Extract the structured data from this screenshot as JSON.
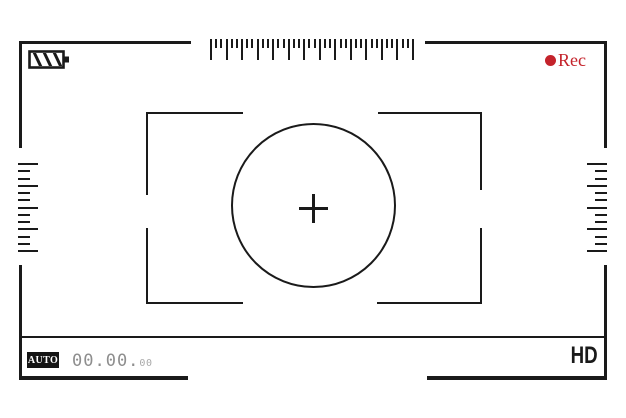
{
  "viewfinder": {
    "frame_color": "#1a1a1a",
    "rec": {
      "label": "Rec",
      "color": "#c4232b",
      "dot_icon": "record-dot-icon"
    },
    "battery": {
      "icon": "battery-icon",
      "stripe_count": 3,
      "level": "striped"
    },
    "timer": {
      "main": "00.00.",
      "frames": "00",
      "color": "#8e8e8e",
      "frames_color": "#a9a9a9"
    },
    "mode_badge": {
      "label": "AUTO"
    },
    "quality": {
      "label": "HD"
    },
    "rulers": {
      "top": {
        "count": 40,
        "step": 5.18,
        "major_len": 21,
        "minor_len": 9,
        "thickness": 2,
        "pattern": "major-minor-minor"
      },
      "left": {
        "count": 13,
        "step": 7.25,
        "major_len": 20,
        "minor_len": 12,
        "thickness": 2,
        "pattern": "major-minor-minor"
      },
      "right": {
        "count": 13,
        "step": 7.25,
        "major_len": 20,
        "minor_len": 12,
        "thickness": 2,
        "pattern": "major-minor-minor"
      }
    }
  }
}
